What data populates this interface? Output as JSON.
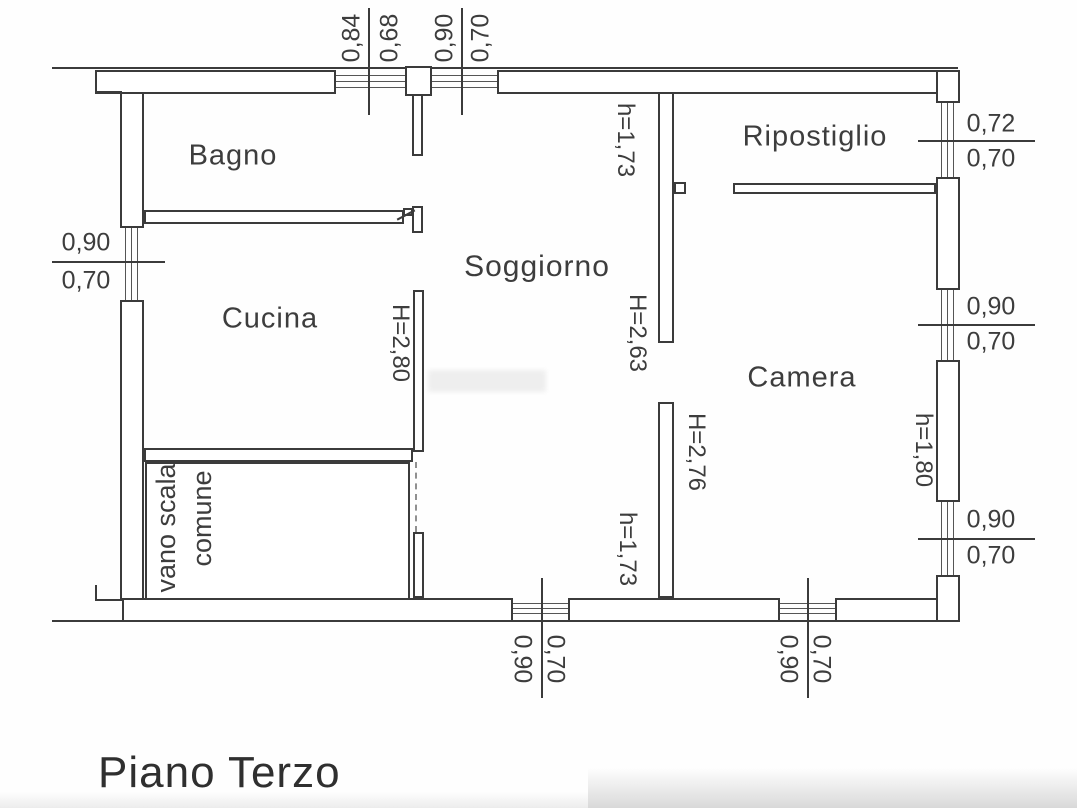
{
  "title": "Piano Terzo",
  "rooms": {
    "bagno": {
      "label": "Bagno"
    },
    "cucina": {
      "label": "Cucina"
    },
    "soggiorno": {
      "label": "Soggiorno"
    },
    "ripostiglio": {
      "label": "Ripostiglio"
    },
    "camera": {
      "label": "Camera"
    },
    "vano_scala": {
      "line1": "vano scala",
      "line2": "comune"
    }
  },
  "heights": {
    "bagno_doorway": "h=1,73",
    "cucina_wall": "H=2,80",
    "soggiorno_doorway": "H=2,63",
    "camera_wall": "H=2,76",
    "camera_doorway": "h=1,73",
    "camera_window": "h=1,80"
  },
  "dimensions": {
    "top_window_1": {
      "width": "0,84",
      "sill": "0,68"
    },
    "top_window_2": {
      "width": "0,90",
      "sill": "0,70"
    },
    "left_window": {
      "width": "0,90",
      "sill": "0,70"
    },
    "right_window_top": {
      "width": "0,72",
      "sill": "0,70"
    },
    "right_window_middle": {
      "width": "0,90",
      "sill": "0,70"
    },
    "right_window_bottom": {
      "width": "0,90",
      "sill": "0,70"
    },
    "bottom_window_left": {
      "width": "0,90",
      "sill": "0,70"
    },
    "bottom_window_right": {
      "width": "0,90",
      "sill": "0,70"
    }
  },
  "colors": {
    "line": "#3b3b3b",
    "text": "#3d3d3d",
    "background": "#ffffff"
  }
}
